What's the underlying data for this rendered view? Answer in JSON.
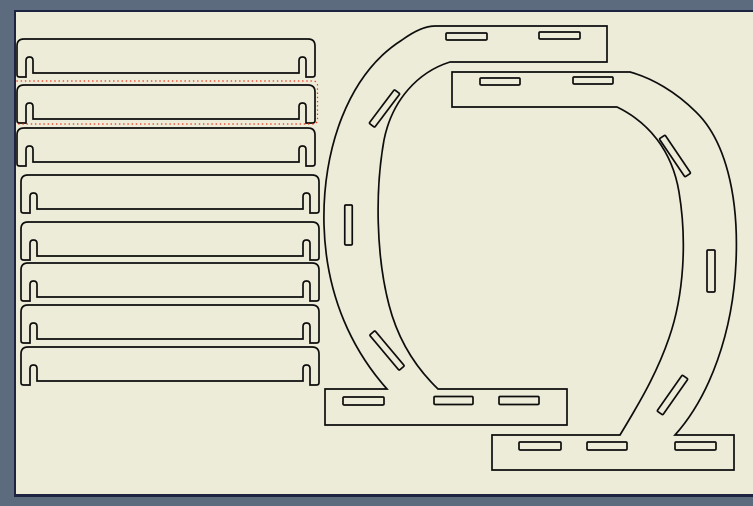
{
  "window": {
    "workspace_color": "#5c6b7e"
  },
  "page": {
    "background_color": "#edecd9",
    "frame_color": "#1d2340"
  },
  "drawing": {
    "stroke_color": "#0d0d0d",
    "stroke_width": 1.7,
    "slat_geometry": {
      "width": 298,
      "corner_radius": 7,
      "foot_corner_radius": 2.5,
      "main_bottom": 34,
      "foot_bottom": 38,
      "slot_top": 18,
      "slot_width": 7,
      "slot_inset": 9,
      "slot_corner_radius": 3.5
    },
    "slats": [
      {
        "id": "slat-1",
        "x": 17,
        "y": 39
      },
      {
        "id": "slat-2",
        "x": 17,
        "y": 85
      },
      {
        "id": "slat-3",
        "x": 17,
        "y": 128
      },
      {
        "id": "slat-4",
        "x": 21,
        "y": 175
      },
      {
        "id": "slat-5",
        "x": 21,
        "y": 222
      },
      {
        "id": "slat-6",
        "x": 21,
        "y": 263
      },
      {
        "id": "slat-7",
        "x": 21,
        "y": 305
      },
      {
        "id": "slat-8",
        "x": 21,
        "y": 347
      }
    ],
    "selection": {
      "target": "slat-2",
      "x": 12.5,
      "y": 81,
      "width": 305,
      "height": 43,
      "corner_radius": 4,
      "color": "#f23318",
      "dash": "1.4 2.8",
      "stroke_width": 1.2
    },
    "slot_format": "cx, cy, length, width, angle_deg",
    "brackets": [
      {
        "id": "c-bracket-left",
        "outline": "M435 26 L607 26 L607 62 L450 62 C418 72 392 100 384 140 C375 190 376 255 389 305 C397 336 412 364 438 389 L567 389 L567 425 L325 425 L325 389 L387 389 C354 352 326 298 324 225 C322 150 348 74 402 40 C413 32 424 26 435 26 Z",
        "slots": [
          [
            466.5,
            36.5,
            41,
            7,
            0
          ],
          [
            559.5,
            35.5,
            41,
            7,
            0
          ],
          [
            384.5,
            108.5,
            42,
            7,
            -53
          ],
          [
            348.5,
            225,
            40,
            7.5,
            90
          ],
          [
            387,
            350.5,
            46,
            7,
            50
          ],
          [
            363.5,
            401,
            41,
            8,
            0
          ],
          [
            453.5,
            400.5,
            39,
            8,
            0
          ],
          [
            519,
            400.5,
            40,
            8,
            0
          ]
        ]
      },
      {
        "id": "c-bracket-right",
        "outline": "M630 72 L452 72 L452 107 L617 107 C648 122 672 150 679 192 C687 240 684 295 669 338 C657 373 640 402 620 435 L492 435 L492 470 L734 470 L734 435 L675 435 C710 396 733 332 736 262 C739 195 725 140 696 112 C676 92 652 78 630 72 Z",
        "slots": [
          [
            500,
            81.5,
            40,
            7,
            0
          ],
          [
            593,
            80.5,
            40,
            7,
            0
          ],
          [
            675,
            156,
            46,
            7,
            56
          ],
          [
            711,
            271,
            42,
            8,
            90
          ],
          [
            672.5,
            395,
            44,
            7,
            125
          ],
          [
            540,
            446,
            42,
            8,
            0
          ],
          [
            607,
            446,
            40,
            8,
            0
          ],
          [
            695.5,
            446,
            41,
            8,
            0
          ]
        ]
      }
    ]
  }
}
